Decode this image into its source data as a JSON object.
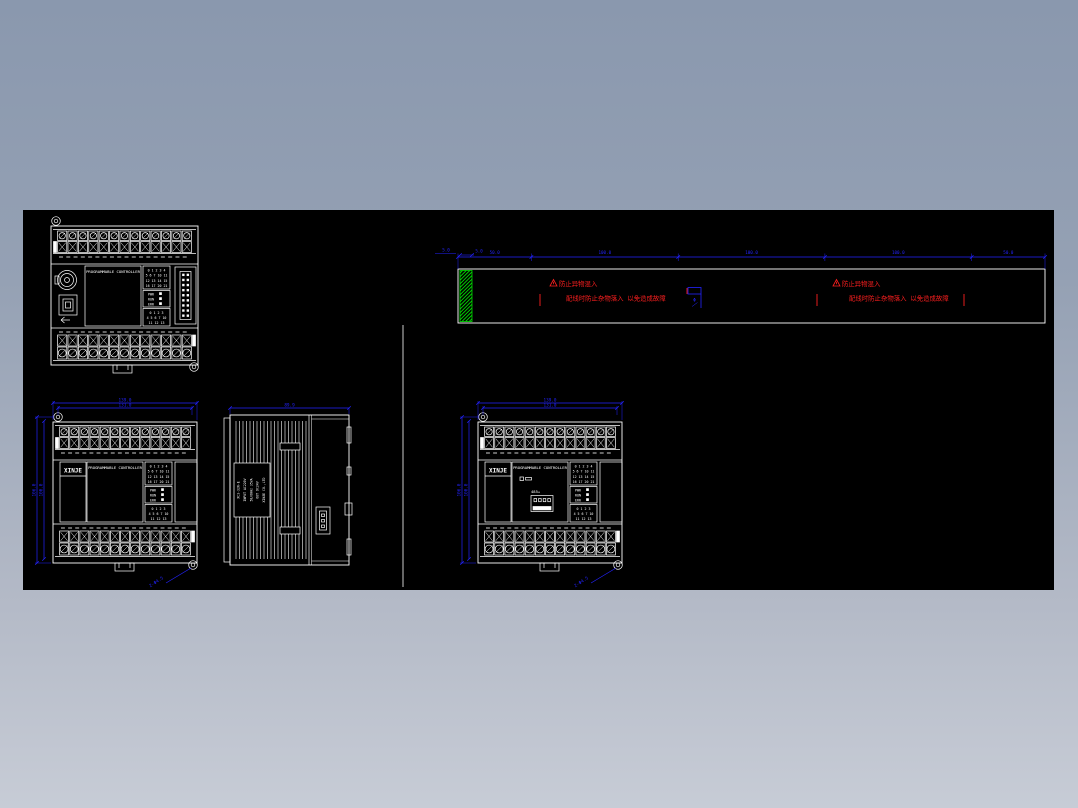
{
  "meta": {
    "view_type": "cad-drawing-sheet",
    "description": "PLC controller installation drawing with front views, side view and DIN mounting rail detail"
  },
  "palette": {
    "background_top": "#8a98ae",
    "background_bottom": "#c7ccd6",
    "canvas": "#000000",
    "line": "#ffffff",
    "dimension": "#2323ff",
    "warning": "#ff1f1f",
    "hatch": "#00dd00"
  },
  "device": {
    "brand": "XINJE",
    "title": "PROGRAMMABLE CONTROLLER",
    "io_top_lines": [
      "0 1 2 3 4",
      "5 6 7 10 11",
      "12 13 14 15",
      "16 17 20 21"
    ],
    "status_lines": [
      "PWR",
      "RUN",
      "ERR"
    ],
    "io_bottom_lines": [
      "0 1 2 3",
      "4 5 6 7 10",
      "11 12 13"
    ],
    "expansion_label": "485+",
    "side_plate_lines": [
      "XC3-32R-E",
      "INPUT AC220V",
      "50/60Hz 35VA",
      "OUT DC24V",
      "XINJE CO.,LTD"
    ]
  },
  "dimensions": {
    "width_outer": "139.0",
    "width_inner": "131.0",
    "height_outer": "106.0",
    "height_inner": "100.0",
    "depth": "89.9",
    "hole_callout": "2-Φ4.5",
    "rail_segments": [
      "50.0",
      "100.0",
      "100.0",
      "100.0",
      "50.0"
    ],
    "rail_left_offset": "5.0",
    "rail_hatch_width": "5.0",
    "rail_hole": "Φ"
  },
  "warnings": {
    "caution_line1": "防止异物混入",
    "caution_line2": "配线时防止杂物落入 以免造成故障"
  }
}
